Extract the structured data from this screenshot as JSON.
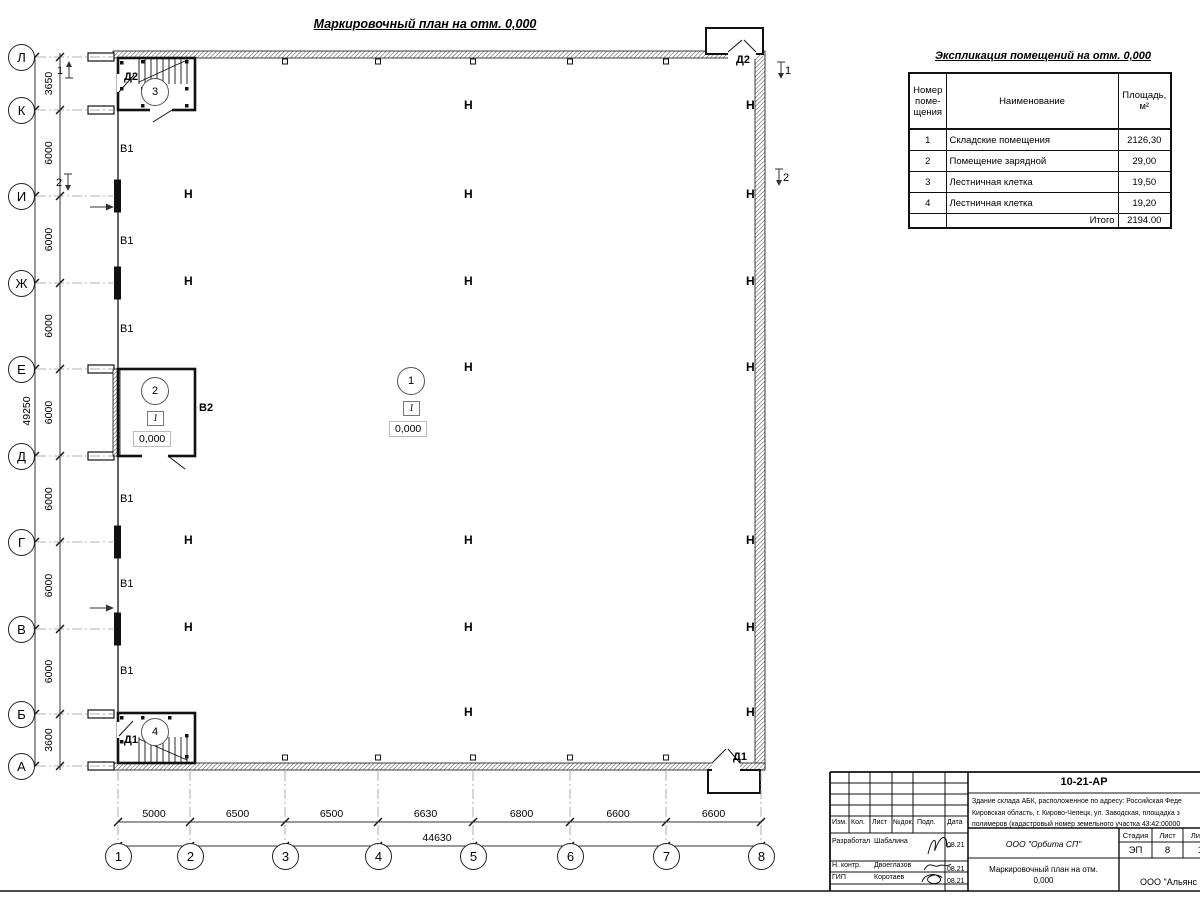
{
  "plan_title": "Маркировочный план на отм. 0,000",
  "expl": {
    "title": "Экспликация помещений на отм. 0,000",
    "headers": [
      "Номер\nпоме-\nщения",
      "Наименование",
      "Площадь,\nм²"
    ],
    "rows": [
      {
        "num": "1",
        "name": "Складские помещения",
        "area": "2126,30"
      },
      {
        "num": "2",
        "name": "Помещение зарядной",
        "area": "29,00"
      },
      {
        "num": "3",
        "name": "Лестничная клетка",
        "area": "19,50"
      },
      {
        "num": "4",
        "name": "Лестничная клетка",
        "area": "19,20"
      }
    ],
    "total_label": "Итого",
    "total_value": "2194.00"
  },
  "axes": {
    "rows": [
      {
        "label": "Л",
        "y": 57
      },
      {
        "label": "К",
        "y": 110
      },
      {
        "label": "И",
        "y": 196
      },
      {
        "label": "Ж",
        "y": 283
      },
      {
        "label": "Е",
        "y": 369
      },
      {
        "label": "Д",
        "y": 456
      },
      {
        "label": "Г",
        "y": 542
      },
      {
        "label": "В",
        "y": 629
      },
      {
        "label": "Б",
        "y": 714
      },
      {
        "label": "А",
        "y": 766
      }
    ],
    "cols": [
      {
        "label": "1",
        "x": 118
      },
      {
        "label": "2",
        "x": 190
      },
      {
        "label": "3",
        "x": 285
      },
      {
        "label": "4",
        "x": 378
      },
      {
        "label": "5",
        "x": 473
      },
      {
        "label": "6",
        "x": 570
      },
      {
        "label": "7",
        "x": 666
      },
      {
        "label": "8",
        "x": 761
      }
    ]
  },
  "dims": {
    "v_segments": [
      {
        "label": "3650",
        "from": 57,
        "to": 110
      },
      {
        "label": "6000",
        "from": 110,
        "to": 196
      },
      {
        "label": "6000",
        "from": 196,
        "to": 283
      },
      {
        "label": "6000",
        "from": 283,
        "to": 369
      },
      {
        "label": "6000",
        "from": 369,
        "to": 456
      },
      {
        "label": "6000",
        "from": 456,
        "to": 542
      },
      {
        "label": "6000",
        "from": 542,
        "to": 629
      },
      {
        "label": "6000",
        "from": 629,
        "to": 714
      },
      {
        "label": "3600",
        "from": 714,
        "to": 766
      }
    ],
    "v_total": "49250",
    "h_segments": [
      {
        "label": "5000",
        "from": 118,
        "to": 190
      },
      {
        "label": "6500",
        "from": 190,
        "to": 285
      },
      {
        "label": "6500",
        "from": 285,
        "to": 378
      },
      {
        "label": "6630",
        "from": 378,
        "to": 473
      },
      {
        "label": "6800",
        "from": 473,
        "to": 570
      },
      {
        "label": "6600",
        "from": 570,
        "to": 666
      },
      {
        "label": "6600",
        "from": 666,
        "to": 761
      }
    ],
    "h_total": "44630"
  },
  "room_tags": [
    {
      "num": "1",
      "x": 411,
      "y": 381,
      "type_mark": "1",
      "level": "0,000"
    },
    {
      "num": "2",
      "x": 155,
      "y": 391,
      "type_mark": "1",
      "level": "0,000"
    },
    {
      "num": "3",
      "x": 155,
      "y": 92,
      "type_mark": null,
      "level": null
    },
    {
      "num": "4",
      "x": 155,
      "y": 732,
      "type_mark": null,
      "level": null
    }
  ],
  "door_labels": [
    {
      "text": "Д2",
      "x": 124,
      "y": 71
    },
    {
      "text": "Д2",
      "x": 736,
      "y": 54
    },
    {
      "text": "В2",
      "x": 199,
      "y": 402
    },
    {
      "text": "Д1",
      "x": 124,
      "y": 734
    },
    {
      "text": "Д1",
      "x": 733,
      "y": 751
    }
  ],
  "gate_labels": [
    {
      "text": "В1",
      "y": 150
    },
    {
      "text": "В1",
      "y": 242
    },
    {
      "text": "В1",
      "y": 330
    },
    {
      "text": "В1",
      "y": 500
    },
    {
      "text": "В1",
      "y": 585
    },
    {
      "text": "В1",
      "y": 672
    }
  ],
  "h_columns": [
    {
      "x": 470,
      "y": 107
    },
    {
      "x": 752,
      "y": 107
    },
    {
      "x": 190,
      "y": 196
    },
    {
      "x": 470,
      "y": 196
    },
    {
      "x": 752,
      "y": 196
    },
    {
      "x": 190,
      "y": 283
    },
    {
      "x": 470,
      "y": 283
    },
    {
      "x": 752,
      "y": 283
    },
    {
      "x": 470,
      "y": 369
    },
    {
      "x": 752,
      "y": 369
    },
    {
      "x": 190,
      "y": 542
    },
    {
      "x": 470,
      "y": 542
    },
    {
      "x": 752,
      "y": 542
    },
    {
      "x": 190,
      "y": 629
    },
    {
      "x": 470,
      "y": 629
    },
    {
      "x": 752,
      "y": 629
    },
    {
      "x": 470,
      "y": 714
    },
    {
      "x": 752,
      "y": 714
    }
  ],
  "section_markers": [
    {
      "num": "1",
      "x": 69,
      "y": 70,
      "dir": "up",
      "side": "left"
    },
    {
      "num": "2",
      "x": 68,
      "y": 182,
      "dir": "down",
      "side": "left"
    },
    {
      "num": "1",
      "x": 781,
      "y": 70,
      "dir": "down",
      "side": "right"
    },
    {
      "num": "2",
      "x": 779,
      "y": 177,
      "dir": "down",
      "side": "right"
    }
  ],
  "title_block": {
    "doc_number": "10-21-АР",
    "description": "Здание склада АБК, расположенное по адресу: Российская Феде\nКировская область, г. Кирово-Чепецк, ул. Заводская, площадка з\nполимеров (кадастровый номер земельного участка 43:42:00000",
    "header_cols": [
      "Изм.",
      "Кол.",
      "Лист",
      "№док.",
      "Подп.",
      "Дата"
    ],
    "people": [
      {
        "role": "Разработал",
        "name": "Шабалина",
        "date": "08.21"
      },
      {
        "role": "Н. контр.",
        "name": "Двоеглазов",
        "date": "08.21"
      },
      {
        "role": "ГИП",
        "name": "Коротаев",
        "date": "08.21"
      }
    ],
    "org": "ООО \"Орбита СП\"",
    "stage_label": "Стадия",
    "sheet_label": "Лист",
    "sheets_label": "Листов",
    "stage": "ЭП",
    "sheet": "8",
    "sheets": "17",
    "drawing_title": "Маркировочный план на отм.\n0,000",
    "company": "ООО \"Альянс"
  }
}
